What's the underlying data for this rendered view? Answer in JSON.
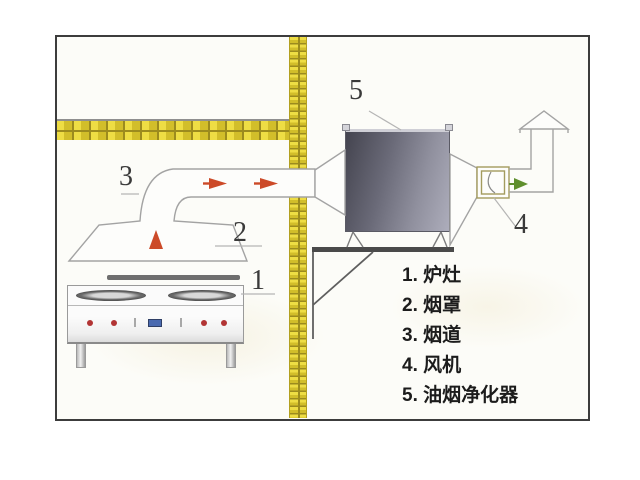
{
  "callouts": {
    "stove": "1",
    "hood": "2",
    "duct": "3",
    "fan": "4",
    "purifier": "5"
  },
  "legend": {
    "items": [
      "1. 炉灶",
      "2. 烟罩",
      "3. 烟道",
      "4. 风机",
      "5. 油烟净化器"
    ]
  },
  "colors": {
    "brick_yellow": "#ddc930",
    "brick_mortar": "#9c8b1e",
    "line_gray": "#a3a3a3",
    "arrow_red": "#cc4a28",
    "arrow_green": "#5f8f2d",
    "purifier_dark": "#44444f",
    "purifier_light": "#adadbb",
    "knob_red": "#b23434",
    "display_blue": "#4a6ab0"
  }
}
